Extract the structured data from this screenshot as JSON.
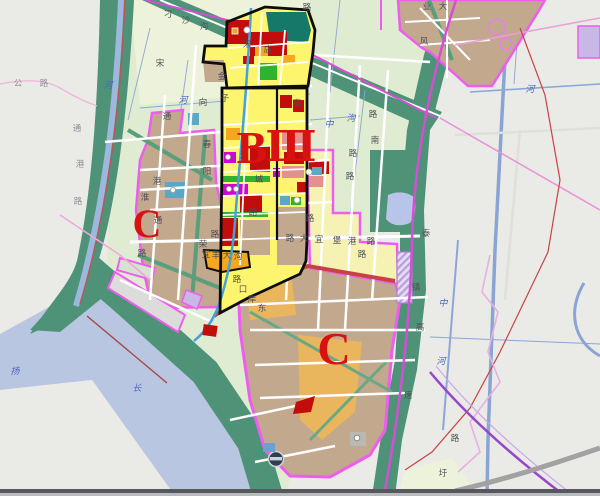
{
  "app": {
    "description": "City zoning / land-use planning map with Yangtze river, black-outlined planning zones B and III, and districts marked C"
  },
  "palette": {
    "gray_land": "#eaeae7",
    "water": "#b9c6e2",
    "field": "#dfecd2",
    "field_pale": "#edf2da",
    "green_band": "#4e9377",
    "green_dark": "#15796a",
    "zone_yellow": "#fdf56d",
    "zone_pale": "#f6f2b4",
    "zone_red": "#c30c0c",
    "zone_orange": "#f4a81f",
    "zone_green": "#2db32d",
    "zone_magenta": "#cf06cf",
    "zone_cyan": "#5ba8c6",
    "tan": "#c2a88d",
    "tan_orange": "#e9b65e",
    "salmon": "#e58f8f",
    "pink_line": "#ef5def",
    "pink_soft": "#efa8dc",
    "river": "#42a4d6",
    "canal": "#8ca6d6",
    "red_line": "#c74343",
    "purple_road": "#9747cc",
    "gray_road": "#a2a2a2",
    "label": "#4d4d55",
    "label_faint": "#8f8f96",
    "blue_label": "#4a68bd",
    "red_letter": "#d81111",
    "black": "#0d0d0d",
    "lavender": "#c9b7e6"
  },
  "map": {
    "zone_letters": [
      {
        "text": "B",
        "x": 252,
        "y": 163,
        "size": 46,
        "name": "zone-label-B"
      },
      {
        "text": "Ⅲ",
        "x": 291,
        "y": 161,
        "size": 42,
        "name": "zone-label-III"
      },
      {
        "text": "C",
        "x": 147,
        "y": 237,
        "size": 40,
        "name": "zone-label-C-west"
      },
      {
        "text": "C",
        "x": 334,
        "y": 364,
        "size": 46,
        "name": "zone-label-C-south"
      }
    ],
    "water_labels": [
      {
        "text": "扬",
        "x": 15,
        "y": 374,
        "size": 17,
        "color": "#7b68c8",
        "name": "river-label-yang"
      },
      {
        "text": "长",
        "x": 137,
        "y": 391,
        "size": 14,
        "name": "river-label-chang"
      },
      {
        "text": "河",
        "x": 108,
        "y": 88,
        "name": "canal-label-he-1"
      },
      {
        "text": "河",
        "x": 183,
        "y": 103,
        "name": "canal-label-he-2"
      },
      {
        "text": "河",
        "x": 530,
        "y": 92,
        "name": "canal-label-he-3"
      },
      {
        "text": "中",
        "x": 443,
        "y": 306,
        "name": "canal-label-zhong"
      },
      {
        "text": "河",
        "x": 441,
        "y": 364,
        "name": "canal-label-he-4"
      },
      {
        "text": "中",
        "x": 329,
        "y": 127,
        "name": "canal-label-zhong-2"
      },
      {
        "text": "沟",
        "x": 351,
        "y": 121,
        "name": "canal-label-gou"
      }
    ],
    "road_labels": [
      {
        "text": "公",
        "x": 18,
        "y": 86,
        "cls": "faint"
      },
      {
        "text": "路",
        "x": 44,
        "y": 86,
        "cls": "faint"
      },
      {
        "text": "通",
        "x": 77,
        "y": 131,
        "cls": "faint"
      },
      {
        "text": "港",
        "x": 80,
        "y": 167,
        "cls": "faint"
      },
      {
        "text": "路",
        "x": 78,
        "y": 204,
        "cls": "faint"
      },
      {
        "text": "刁",
        "x": 168,
        "y": 17
      },
      {
        "text": "沙",
        "x": 186,
        "y": 23
      },
      {
        "text": "沟",
        "x": 204,
        "y": 29
      },
      {
        "text": "宋",
        "x": 160,
        "y": 66
      },
      {
        "text": "向",
        "x": 203,
        "y": 105
      },
      {
        "text": "金",
        "x": 222,
        "y": 79
      },
      {
        "text": "子",
        "x": 225,
        "y": 101
      },
      {
        "text": "宋",
        "x": 247,
        "y": 47
      },
      {
        "text": "店",
        "x": 268,
        "y": 52
      },
      {
        "text": "路",
        "x": 307,
        "y": 10
      },
      {
        "text": "业",
        "x": 427,
        "y": 9
      },
      {
        "text": "高",
        "x": 297,
        "y": 106
      },
      {
        "text": "春",
        "x": 207,
        "y": 147
      },
      {
        "text": "阳",
        "x": 207,
        "y": 174
      },
      {
        "text": "通",
        "x": 167,
        "y": 119
      },
      {
        "text": "淮",
        "x": 145,
        "y": 200
      },
      {
        "text": "港",
        "x": 157,
        "y": 184
      },
      {
        "text": "通",
        "x": 158,
        "y": 223
      },
      {
        "text": "路",
        "x": 142,
        "y": 256
      },
      {
        "text": "江",
        "x": 244,
        "y": 158
      },
      {
        "text": "城",
        "x": 259,
        "y": 182
      },
      {
        "text": "路",
        "x": 253,
        "y": 215
      },
      {
        "text": "路",
        "x": 215,
        "y": 237
      },
      {
        "text": "荣",
        "x": 203,
        "y": 247
      },
      {
        "text": "路",
        "x": 290,
        "y": 241
      },
      {
        "text": "大",
        "x": 304,
        "y": 241
      },
      {
        "text": "宜",
        "x": 319,
        "y": 242
      },
      {
        "text": "堡",
        "x": 337,
        "y": 243
      },
      {
        "text": "港",
        "x": 352,
        "y": 244
      },
      {
        "text": "路",
        "x": 371,
        "y": 244
      },
      {
        "text": "宜",
        "x": 206,
        "y": 257,
        "size": 6.5
      },
      {
        "text": "丰",
        "x": 216,
        "y": 258,
        "size": 6.5
      },
      {
        "text": "大",
        "x": 227,
        "y": 258,
        "size": 6.5
      },
      {
        "text": "沟",
        "x": 238,
        "y": 259,
        "size": 6.5
      },
      {
        "text": "口",
        "x": 243,
        "y": 292
      },
      {
        "text": "岸",
        "x": 252,
        "y": 302
      },
      {
        "text": "东",
        "x": 262,
        "y": 311
      },
      {
        "text": "路",
        "x": 237,
        "y": 282
      },
      {
        "text": "路",
        "x": 310,
        "y": 221
      },
      {
        "text": "路",
        "x": 350,
        "y": 179
      },
      {
        "text": "路",
        "x": 353,
        "y": 156
      },
      {
        "text": "路",
        "x": 373,
        "y": 117
      },
      {
        "text": "南",
        "x": 375,
        "y": 143
      },
      {
        "text": "路",
        "x": 362,
        "y": 257
      },
      {
        "text": "镇",
        "x": 416,
        "y": 290
      },
      {
        "text": "高",
        "x": 420,
        "y": 330
      },
      {
        "text": "速",
        "x": 408,
        "y": 398
      },
      {
        "text": "泰",
        "x": 426,
        "y": 236
      },
      {
        "text": "大",
        "x": 443,
        "y": 9
      },
      {
        "text": "风",
        "x": 424,
        "y": 44
      },
      {
        "text": "圩",
        "x": 443,
        "y": 476
      },
      {
        "text": "路",
        "x": 455,
        "y": 441
      }
    ]
  }
}
